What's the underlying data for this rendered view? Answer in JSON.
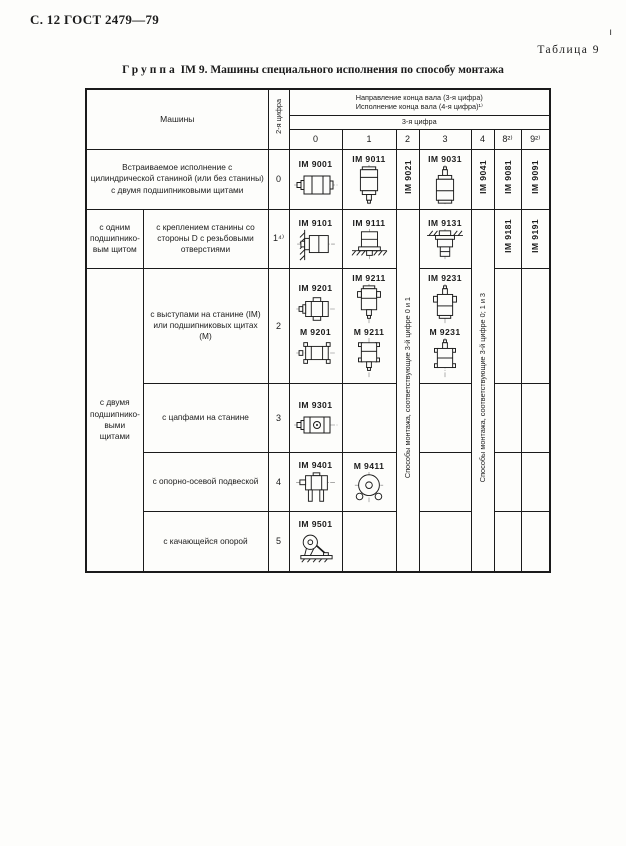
{
  "page": {
    "header_left": "С. 12 ГОСТ 2479—79",
    "table_label": "Таблица 9",
    "scan_mark": "ı",
    "title_group": "Группа",
    "title_rest": "IM 9. Машины специального исполнения по способу монтажа"
  },
  "table": {
    "machines_header": "Машины",
    "digit2_header": "2-я цифра",
    "dir_line1": "Направление конца вала (3-я цифра)",
    "dir_line2": "Исполнение конца вала (4-я цифра)¹⁾",
    "digit3_header": "3-я цифра",
    "digit_columns": [
      "0",
      "1",
      "2",
      "3",
      "4",
      "8²⁾",
      "9²⁾"
    ],
    "span_col2": "Способы монтажа, соответствующие 3-й цифре 0 и 1",
    "span_col4": "Способы монтажа, соответствующие 3-й цифре 0; 1 и 3",
    "rows": [
      {
        "desc": "Встраиваемое исполнение с цилиндрической станиной (или без станины) с двумя подшипниковыми щитами",
        "digit": "0",
        "codes": {
          "c0": "IM 9001",
          "c1": "IM 9011",
          "c2": "IM 9021",
          "c3": "IM 9031",
          "c4": "IM 9041",
          "c8": "IM 9081",
          "c9": "IM 9091"
        }
      },
      {
        "group": "с одним подшипнико- вым щитом",
        "desc": "с креплением станины со стороны D с резьбовыми отверстиями",
        "digit": "1⁴⁾",
        "codes": {
          "c0": "IM 9101",
          "c1": "IM 9111",
          "c3": "IM 9131",
          "c8": "IM 9181",
          "c9": "IM 9191"
        }
      },
      {
        "group": "с двумя подшипнико- выми щитами",
        "desc": "с выступами на станине (IM) или подшипниковых щитах (М)",
        "digit": "2",
        "codes": {
          "c0a": "IM 9201",
          "c0b": "М 9201",
          "c1a": "IM 9211",
          "c1b": "М 9211",
          "c3a": "IM 9231",
          "c3b": "М 9231"
        }
      },
      {
        "desc": "с цапфами на станине",
        "digit": "3",
        "codes": {
          "c0": "IM 9301"
        }
      },
      {
        "desc": "с опорно-осевой подвеской",
        "digit": "4",
        "codes": {
          "c0": "IM 9401",
          "c1": "М 9411"
        }
      },
      {
        "desc": "с качающейся опорой",
        "digit": "5",
        "codes": {
          "c0": "IM 9501"
        }
      }
    ],
    "icons": {
      "im9001": "motor-horizontal-shaft-left",
      "im9011": "motor-vertical-shaft-down",
      "im9031": "motor-vertical-shaft-up",
      "im9101": "motor-wall-mounted",
      "im9111": "motor-floor-mounted-vertical",
      "im9131": "motor-ceiling-mounted",
      "im9201": "motor-horizontal-frame-lugs",
      "m9201": "motor-horizontal-shield-lugs",
      "im9211": "motor-vertical-frame-lugs",
      "m9211": "motor-vertical-shield-lugs",
      "im9231": "motor-vertical-up-frame-lugs",
      "m9231": "motor-vertical-up-shield-lugs",
      "im9301": "motor-with-trunnions",
      "im9401": "motor-axle-suspension",
      "m9411": "motor-axle-suspension-front-view",
      "im9501": "motor-rocking-support"
    }
  }
}
